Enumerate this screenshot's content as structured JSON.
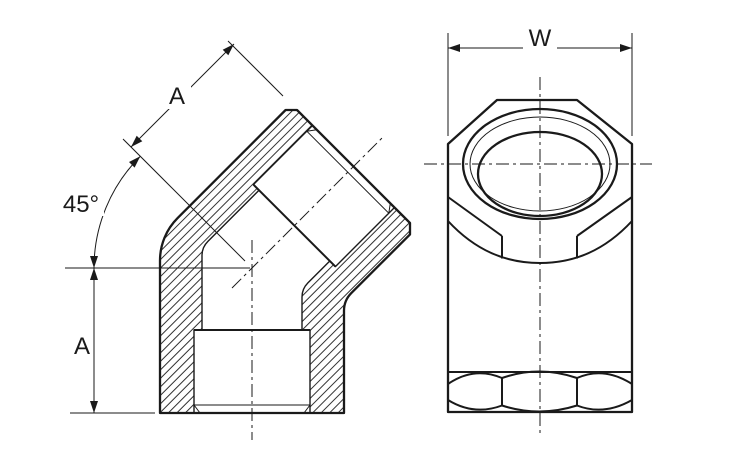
{
  "colors": {
    "ink": "#1a1a1a",
    "background": "#ffffff"
  },
  "labels": {
    "length_upper": "A",
    "length_lower": "A",
    "angle": "45°",
    "width_across_flats": "W"
  }
}
